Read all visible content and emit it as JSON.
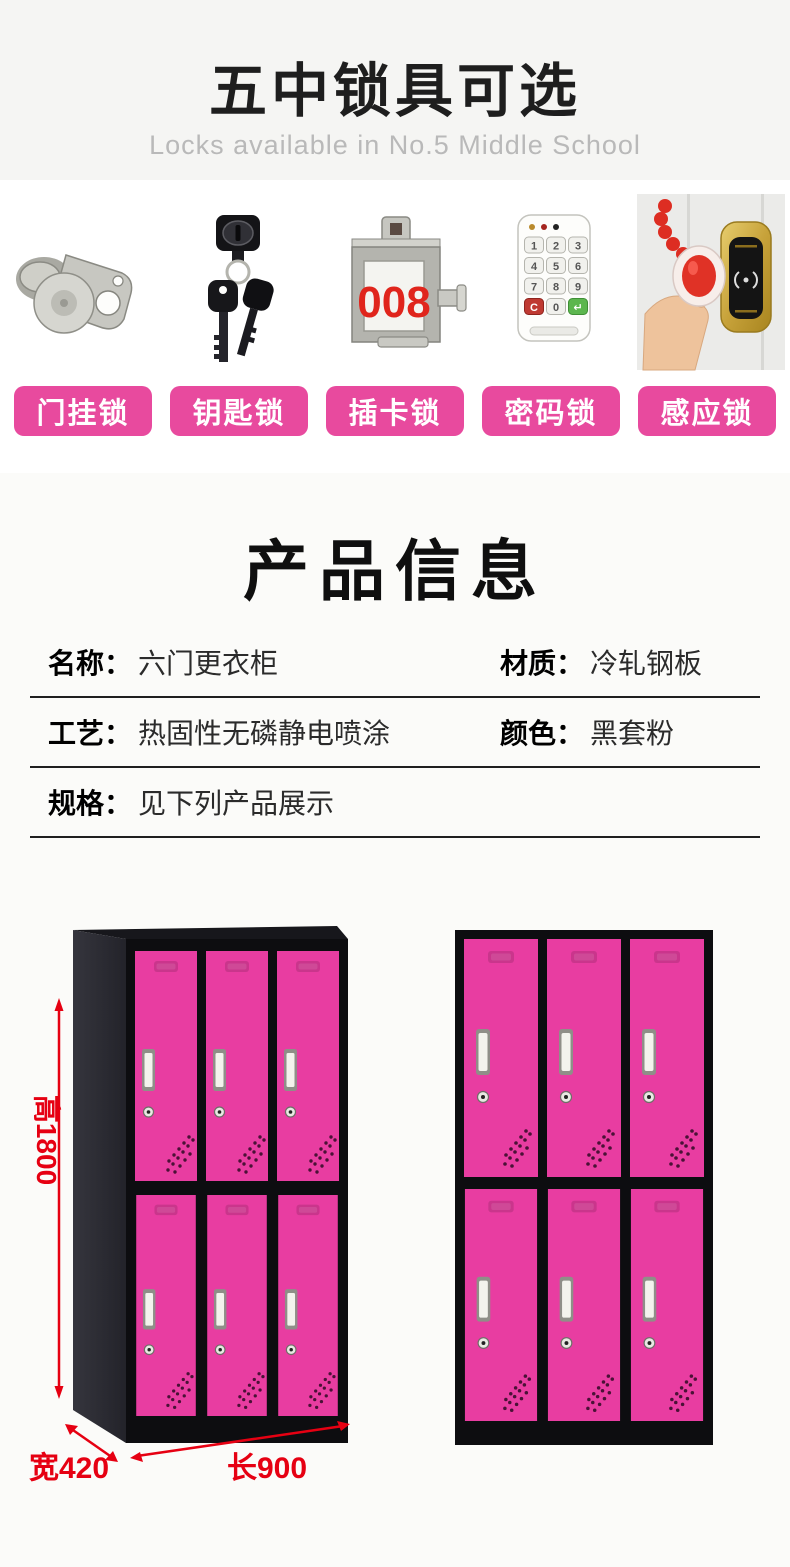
{
  "header": {
    "title": "五中锁具可选",
    "subtitle": "Locks available in No.5 Middle School"
  },
  "locks": {
    "items": [
      {
        "name": "hasp-lock",
        "label": "门挂锁"
      },
      {
        "name": "key-lock",
        "label": "钥匙锁"
      },
      {
        "name": "card-lock",
        "label": "插卡锁"
      },
      {
        "name": "keypad-lock",
        "label": "密码锁"
      },
      {
        "name": "rfid-lock",
        "label": "感应锁"
      }
    ],
    "card_display_number": "008",
    "keypad_keys": [
      "1",
      "2",
      "3",
      "4",
      "5",
      "6",
      "7",
      "8",
      "9",
      "C",
      "0",
      "↵"
    ]
  },
  "product_info": {
    "title": "产品信息",
    "rows": [
      {
        "cells": [
          {
            "label": "名称：",
            "value": "六门更衣柜"
          },
          {
            "label": "材质：",
            "value": "冷轧钢板"
          }
        ]
      },
      {
        "cells": [
          {
            "label": "工艺：",
            "value": "热固性无磷静电喷涂"
          },
          {
            "label": "颜色：",
            "value": "黑套粉"
          }
        ]
      },
      {
        "cells": [
          {
            "label": "规格：",
            "value": "见下列产品展示"
          }
        ]
      }
    ]
  },
  "lockers": {
    "description": "six-door locker, black frame with pink doors",
    "dimensions": {
      "height": "高1800",
      "width": "宽420",
      "length": "长900"
    }
  },
  "colors": {
    "button_pink": "#e84a9e",
    "door_pink": "#e83da1",
    "dim_red": "#e60012",
    "frame_black": "#0d0d10",
    "top_band_bg": "#f5f5f3",
    "lower_bg": "#fbfbf9",
    "card_red": "#e0251c"
  }
}
